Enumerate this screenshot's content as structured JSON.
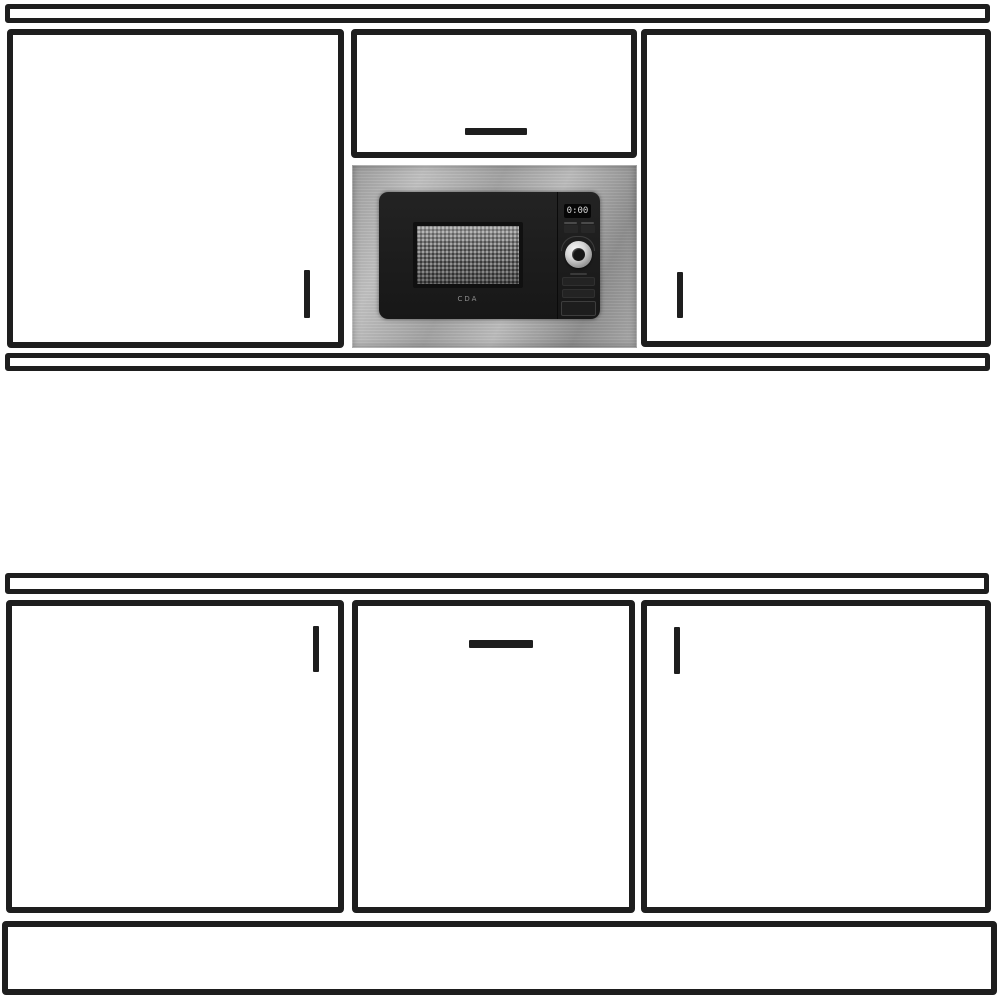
{
  "diagram": {
    "subject": "kitchen-unit-elevation-with-built-in-microwave",
    "top_run": {
      "parts": [
        "cornice-rail",
        "wall-cabinet-left",
        "top-box-cabinet",
        "built-in-microwave",
        "wall-cabinet-right",
        "pelmet-rail"
      ],
      "handles": [
        {
          "cabinet": "wall-cabinet-left",
          "orientation": "vertical",
          "position": "bottom-right"
        },
        {
          "cabinet": "top-box-cabinet",
          "orientation": "horizontal",
          "position": "bottom-center"
        },
        {
          "cabinet": "wall-cabinet-right",
          "orientation": "vertical",
          "position": "bottom-left"
        }
      ]
    },
    "bottom_run": {
      "parts": [
        "worktop-rail",
        "base-cabinet-left",
        "base-cabinet-middle",
        "base-cabinet-right",
        "plinth-panel"
      ],
      "handles": [
        {
          "cabinet": "base-cabinet-left",
          "orientation": "vertical",
          "position": "top-right"
        },
        {
          "cabinet": "base-cabinet-middle",
          "orientation": "horizontal",
          "position": "top-center"
        },
        {
          "cabinet": "base-cabinet-right",
          "orientation": "vertical",
          "position": "top-left"
        }
      ]
    }
  },
  "microwave": {
    "brand": "CDA",
    "display_value": "0:00",
    "controls": [
      "digital-display",
      "program-button",
      "stop-button",
      "rotary-knob",
      "time-button",
      "weight-button",
      "door-open-button"
    ]
  },
  "colors": {
    "line": "#1e1e1e",
    "bg": "#ffffff",
    "steel_light": "#c2c2c2",
    "steel_dark": "#8f8f8f",
    "door_black": "#1b1b1b",
    "mesh_gray": "#686868"
  }
}
